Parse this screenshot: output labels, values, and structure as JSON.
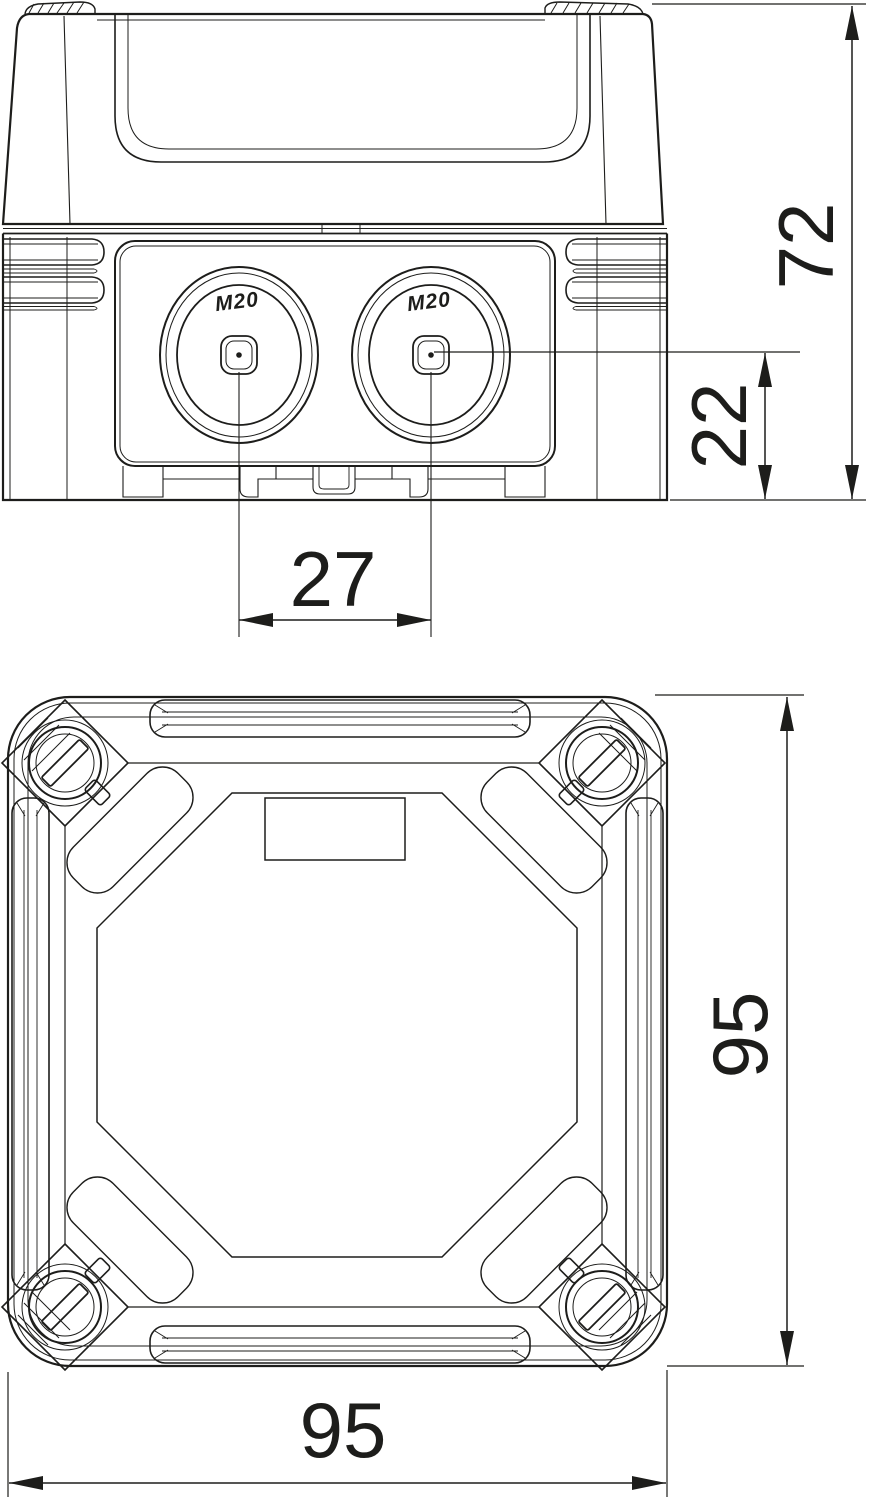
{
  "drawing": {
    "title": "junction-box-dimension-drawing",
    "background": "#ffffff",
    "line_color": "#1d1d1b",
    "views": {
      "front_view": "front elevation with cable entries",
      "plan_view": "top view with cover screws"
    },
    "labels": {
      "left_entry": "M20",
      "right_entry": "M20"
    },
    "dimensions": {
      "overall_height": "72",
      "entry_center_from_bottom": "22",
      "entry_spacing": "27",
      "overall_height_plan": "95",
      "overall_width_plan": "95"
    }
  }
}
